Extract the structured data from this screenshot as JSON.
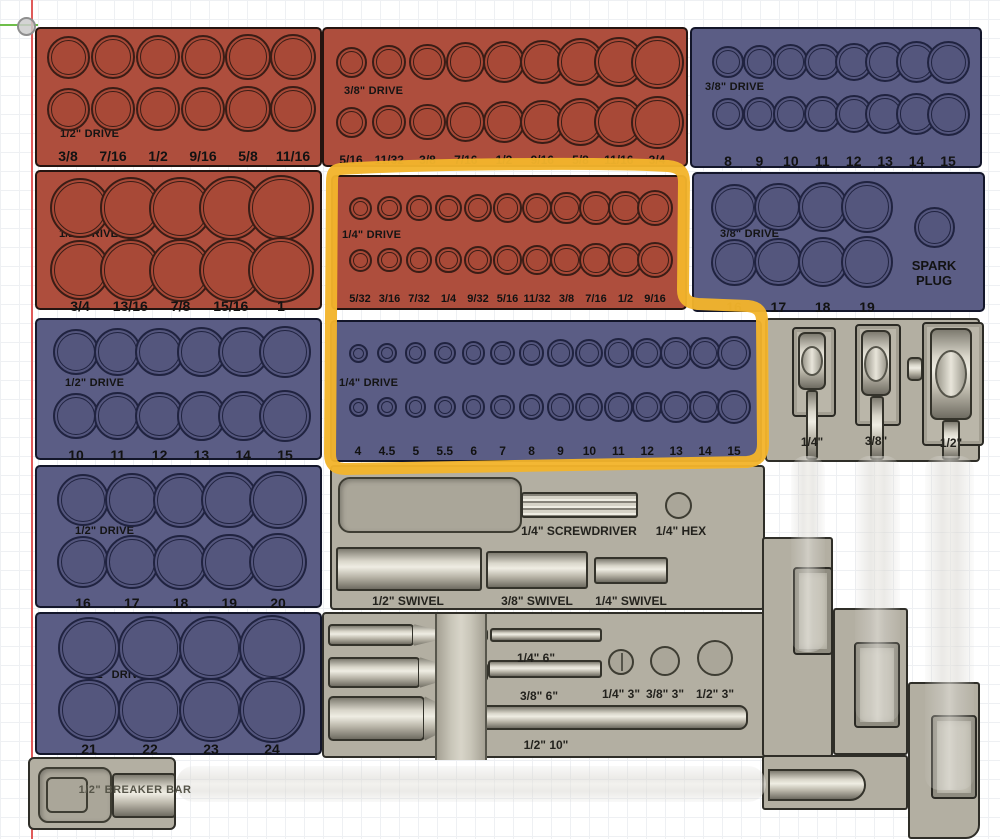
{
  "canvas": {
    "width": 1000,
    "height": 839
  },
  "colors": {
    "red_panel": "#AE4E3D",
    "blue_panel": "#5B5D85",
    "tray_gray": "#B3AFA2",
    "highlight": "#F2B42C",
    "axis_red": "#E05A5A",
    "axis_green": "#6FBE4A"
  },
  "highlight": {
    "color": "#F2B42C"
  },
  "panels": [
    {
      "id": "half-drive-sae-small",
      "color": "red",
      "x": 35,
      "y": 27,
      "w": 287,
      "h": 140,
      "drive": "1/2\" DRIVE",
      "drive_x": 23,
      "drive_y": 99,
      "labels": [
        "3/8",
        "7/16",
        "1/2",
        "9/16",
        "5/8",
        "11/16"
      ],
      "d0": 43,
      "d1": 46,
      "padL": 31,
      "padR": 31,
      "cy1": 28,
      "cy2": 80,
      "labelY": 119,
      "labelSize": 14
    },
    {
      "id": "three-eighth-drive-sae",
      "color": "red",
      "x": 322,
      "y": 27,
      "w": 366,
      "h": 140,
      "drive": "3/8\" DRIVE",
      "drive_x": 20,
      "drive_y": 56,
      "labels": [
        "5/16",
        "11/32",
        "3/8",
        "7/16",
        "1/2",
        "9/16",
        "5/8",
        "11/16",
        "3/4"
      ],
      "d0": 31,
      "d1": 53,
      "padL": 27,
      "padR": 33,
      "cy1": 33,
      "cy2": 93,
      "labelY": 124,
      "labelSize": 12
    },
    {
      "id": "three-eighth-drive-metric",
      "color": "blue",
      "x": 690,
      "y": 27,
      "w": 292,
      "h": 141,
      "drive": "3/8\" DRIVE",
      "drive_x": 13,
      "drive_y": 52,
      "labels": [
        "8",
        "9",
        "10",
        "11",
        "12",
        "13",
        "14",
        "15"
      ],
      "d0": 32,
      "d1": 43,
      "padL": 36,
      "padR": 36,
      "cy1": 33,
      "cy2": 85,
      "labelY": 124,
      "labelSize": 14
    },
    {
      "id": "half-drive-sae-large",
      "color": "red",
      "x": 35,
      "y": 170,
      "w": 287,
      "h": 140,
      "drive": "1/2\" DRIVE",
      "drive_x": 22,
      "drive_y": 56,
      "labels": [
        "3/4",
        "13/16",
        "7/8",
        "15/16",
        "1"
      ],
      "d0": 60,
      "d1": 66,
      "padL": 43,
      "padR": 43,
      "cy1": 36,
      "cy2": 98,
      "labelY": 126,
      "labelSize": 14
    },
    {
      "id": "quarter-drive-sae",
      "color": "red",
      "x": 331,
      "y": 175,
      "w": 356,
      "h": 135,
      "drive": "1/4\" DRIVE",
      "drive_x": 9,
      "drive_y": 52,
      "labels": [
        "5/32",
        "3/16",
        "7/32",
        "1/4",
        "9/32",
        "5/16",
        "11/32",
        "3/8",
        "7/16",
        "1/2",
        "9/16"
      ],
      "d0": 23,
      "d1": 36,
      "padL": 27,
      "padR": 34,
      "cy1": 31,
      "cy2": 83,
      "labelY": 116,
      "labelSize": 11
    },
    {
      "id": "three-eighth-drive-large-metric",
      "color": "blue",
      "x": 692,
      "y": 172,
      "w": 293,
      "h": 140,
      "drive": "3/8\" DRIVE",
      "drive_x": 26,
      "drive_y": 54,
      "labels": [
        "16",
        "17",
        "18",
        "19"
      ],
      "d0": 47,
      "d1": 52,
      "padL": 40,
      "padR": 120,
      "cy1": 33,
      "cy2": 88,
      "labelY": 125,
      "labelSize": 14,
      "spark": {
        "cx": 240,
        "cy": 53,
        "d": 41,
        "lines": [
          "SPARK",
          "PLUG"
        ],
        "label_y": 84
      }
    },
    {
      "id": "half-drive-metric-small",
      "color": "blue",
      "x": 35,
      "y": 318,
      "w": 287,
      "h": 142,
      "drive": "1/2\" DRIVE",
      "drive_x": 28,
      "drive_y": 57,
      "labels": [
        "10",
        "11",
        "12",
        "13",
        "14",
        "15"
      ],
      "d0": 46,
      "d1": 52,
      "padL": 39,
      "padR": 39,
      "cy1": 32,
      "cy2": 96,
      "labelY": 127,
      "labelSize": 14
    },
    {
      "id": "quarter-drive-metric",
      "color": "blue",
      "x": 330,
      "y": 320,
      "w": 432,
      "h": 142,
      "drive": "1/4\" DRIVE",
      "drive_x": 7,
      "drive_y": 55,
      "labels": [
        "4",
        "4.5",
        "5",
        "5.5",
        "6",
        "7",
        "8",
        "9",
        "10",
        "11",
        "12",
        "13",
        "14",
        "15"
      ],
      "d0": 19,
      "d1": 34,
      "padL": 26,
      "padR": 30,
      "cy1": 31,
      "cy2": 85,
      "labelY": 122,
      "labelSize": 12
    },
    {
      "id": "half-drive-metric-mid",
      "color": "blue",
      "x": 35,
      "y": 465,
      "w": 287,
      "h": 143,
      "drive": "1/2\" DRIVE",
      "drive_x": 38,
      "drive_y": 58,
      "labels": [
        "16",
        "17",
        "18",
        "19",
        "20"
      ],
      "d0": 52,
      "d1": 58,
      "padL": 46,
      "padR": 46,
      "cy1": 33,
      "cy2": 95,
      "labelY": 128,
      "labelSize": 14
    },
    {
      "id": "half-drive-metric-large",
      "color": "blue",
      "x": 35,
      "y": 612,
      "w": 287,
      "h": 143,
      "drive": "1/2\" DRIVE",
      "drive_x": 50,
      "drive_y": 55,
      "labels": [
        "21",
        "22",
        "23",
        "24"
      ],
      "d0": 62,
      "d1": 66,
      "padL": 52,
      "padR": 52,
      "cy1": 34,
      "cy2": 96,
      "labelY": 127,
      "labelSize": 14
    }
  ],
  "tools": {
    "ratchet_labels": [
      "1/4\"",
      "3/8\"",
      "1/2\""
    ],
    "screwdriver_label": "1/4\" SCREWDRIVER",
    "hex_label": "1/4\" HEX",
    "swivel_labels": [
      "1/2\" SWIVEL",
      "3/8\" SWIVEL",
      "1/4\" SWIVEL"
    ],
    "extension_labels": [
      "1/4\" 6\"",
      "3/8\" 6\"",
      "1/2\" 10\""
    ],
    "short_extension_labels": [
      "1/4\" 3\"",
      "3/8\" 3\"",
      "1/2\" 3\""
    ],
    "breaker_label": "1/2\" BREAKER BAR"
  }
}
